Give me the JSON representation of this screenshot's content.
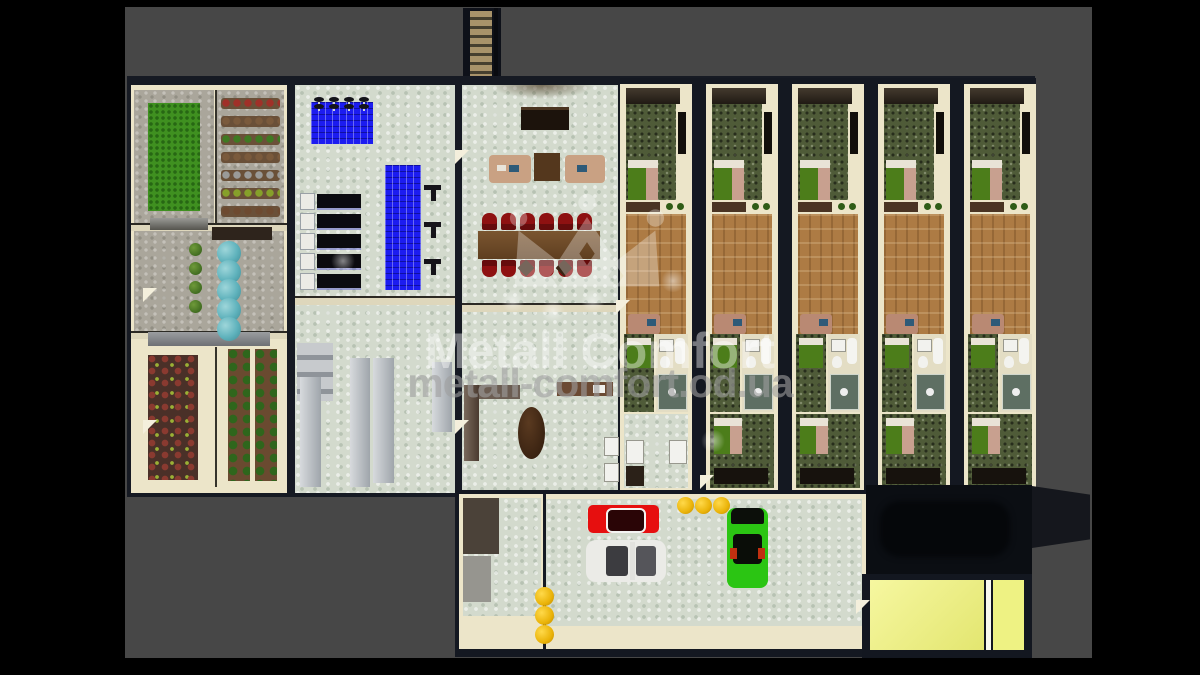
{
  "watermark": {
    "brand": "Metall Comfort",
    "url": "metall-comfort.od.ua",
    "logo": "crown-icon"
  },
  "scene": {
    "description": "Top-down 3D architectural render of a modular building complex on a gray stage",
    "sections": [
      {
        "id": "greenhouse-wing",
        "label": "Greenhouse wing"
      },
      {
        "id": "gym-hall",
        "label": "Gym hall"
      },
      {
        "id": "lobby-hall",
        "label": "Lobby and conference hall"
      },
      {
        "id": "hotel-rooms",
        "label": "Hotel room modules"
      },
      {
        "id": "garage",
        "label": "Garage"
      },
      {
        "id": "dark-hangar",
        "label": "Unlit hangar"
      },
      {
        "id": "lit-entrance",
        "label": "Lit entrance rooms"
      },
      {
        "id": "staircase",
        "label": "Exterior staircase"
      }
    ],
    "counts": {
      "hotel_room_strips": 5,
      "gym_benches": 5,
      "gym_barbells": 4,
      "gym_rack_hooks": 3,
      "conference_chairs_per_row": 6,
      "teal_barrels": 5,
      "yellow_barrels_top": 3,
      "yellow_barrels_side": 3,
      "greenhouse_plant_rows": 7,
      "cars": 3
    },
    "cars": [
      {
        "name": "red-car",
        "color": "#e60f0f"
      },
      {
        "name": "white-car",
        "color": "#ebebe7"
      },
      {
        "name": "green-car",
        "color": "#2bc513"
      }
    ],
    "palette": {
      "canvas": "#000000",
      "stage": "#474747",
      "walls": "#161a23",
      "inner_wall": "#ece5c9",
      "tile_floor": "#d3dacd",
      "wood_floor": "#ad7b44",
      "grass": "#3f9020",
      "gym_mat_blue": "#1c1cf0",
      "conference_red": "#8e1111",
      "bed_green": "#4c7d1a",
      "carpet_green": "#4f5b38",
      "barrel_teal": "#5fb2bc",
      "barrel_yellow": "#eab308",
      "bright_room": "#eef283"
    }
  }
}
